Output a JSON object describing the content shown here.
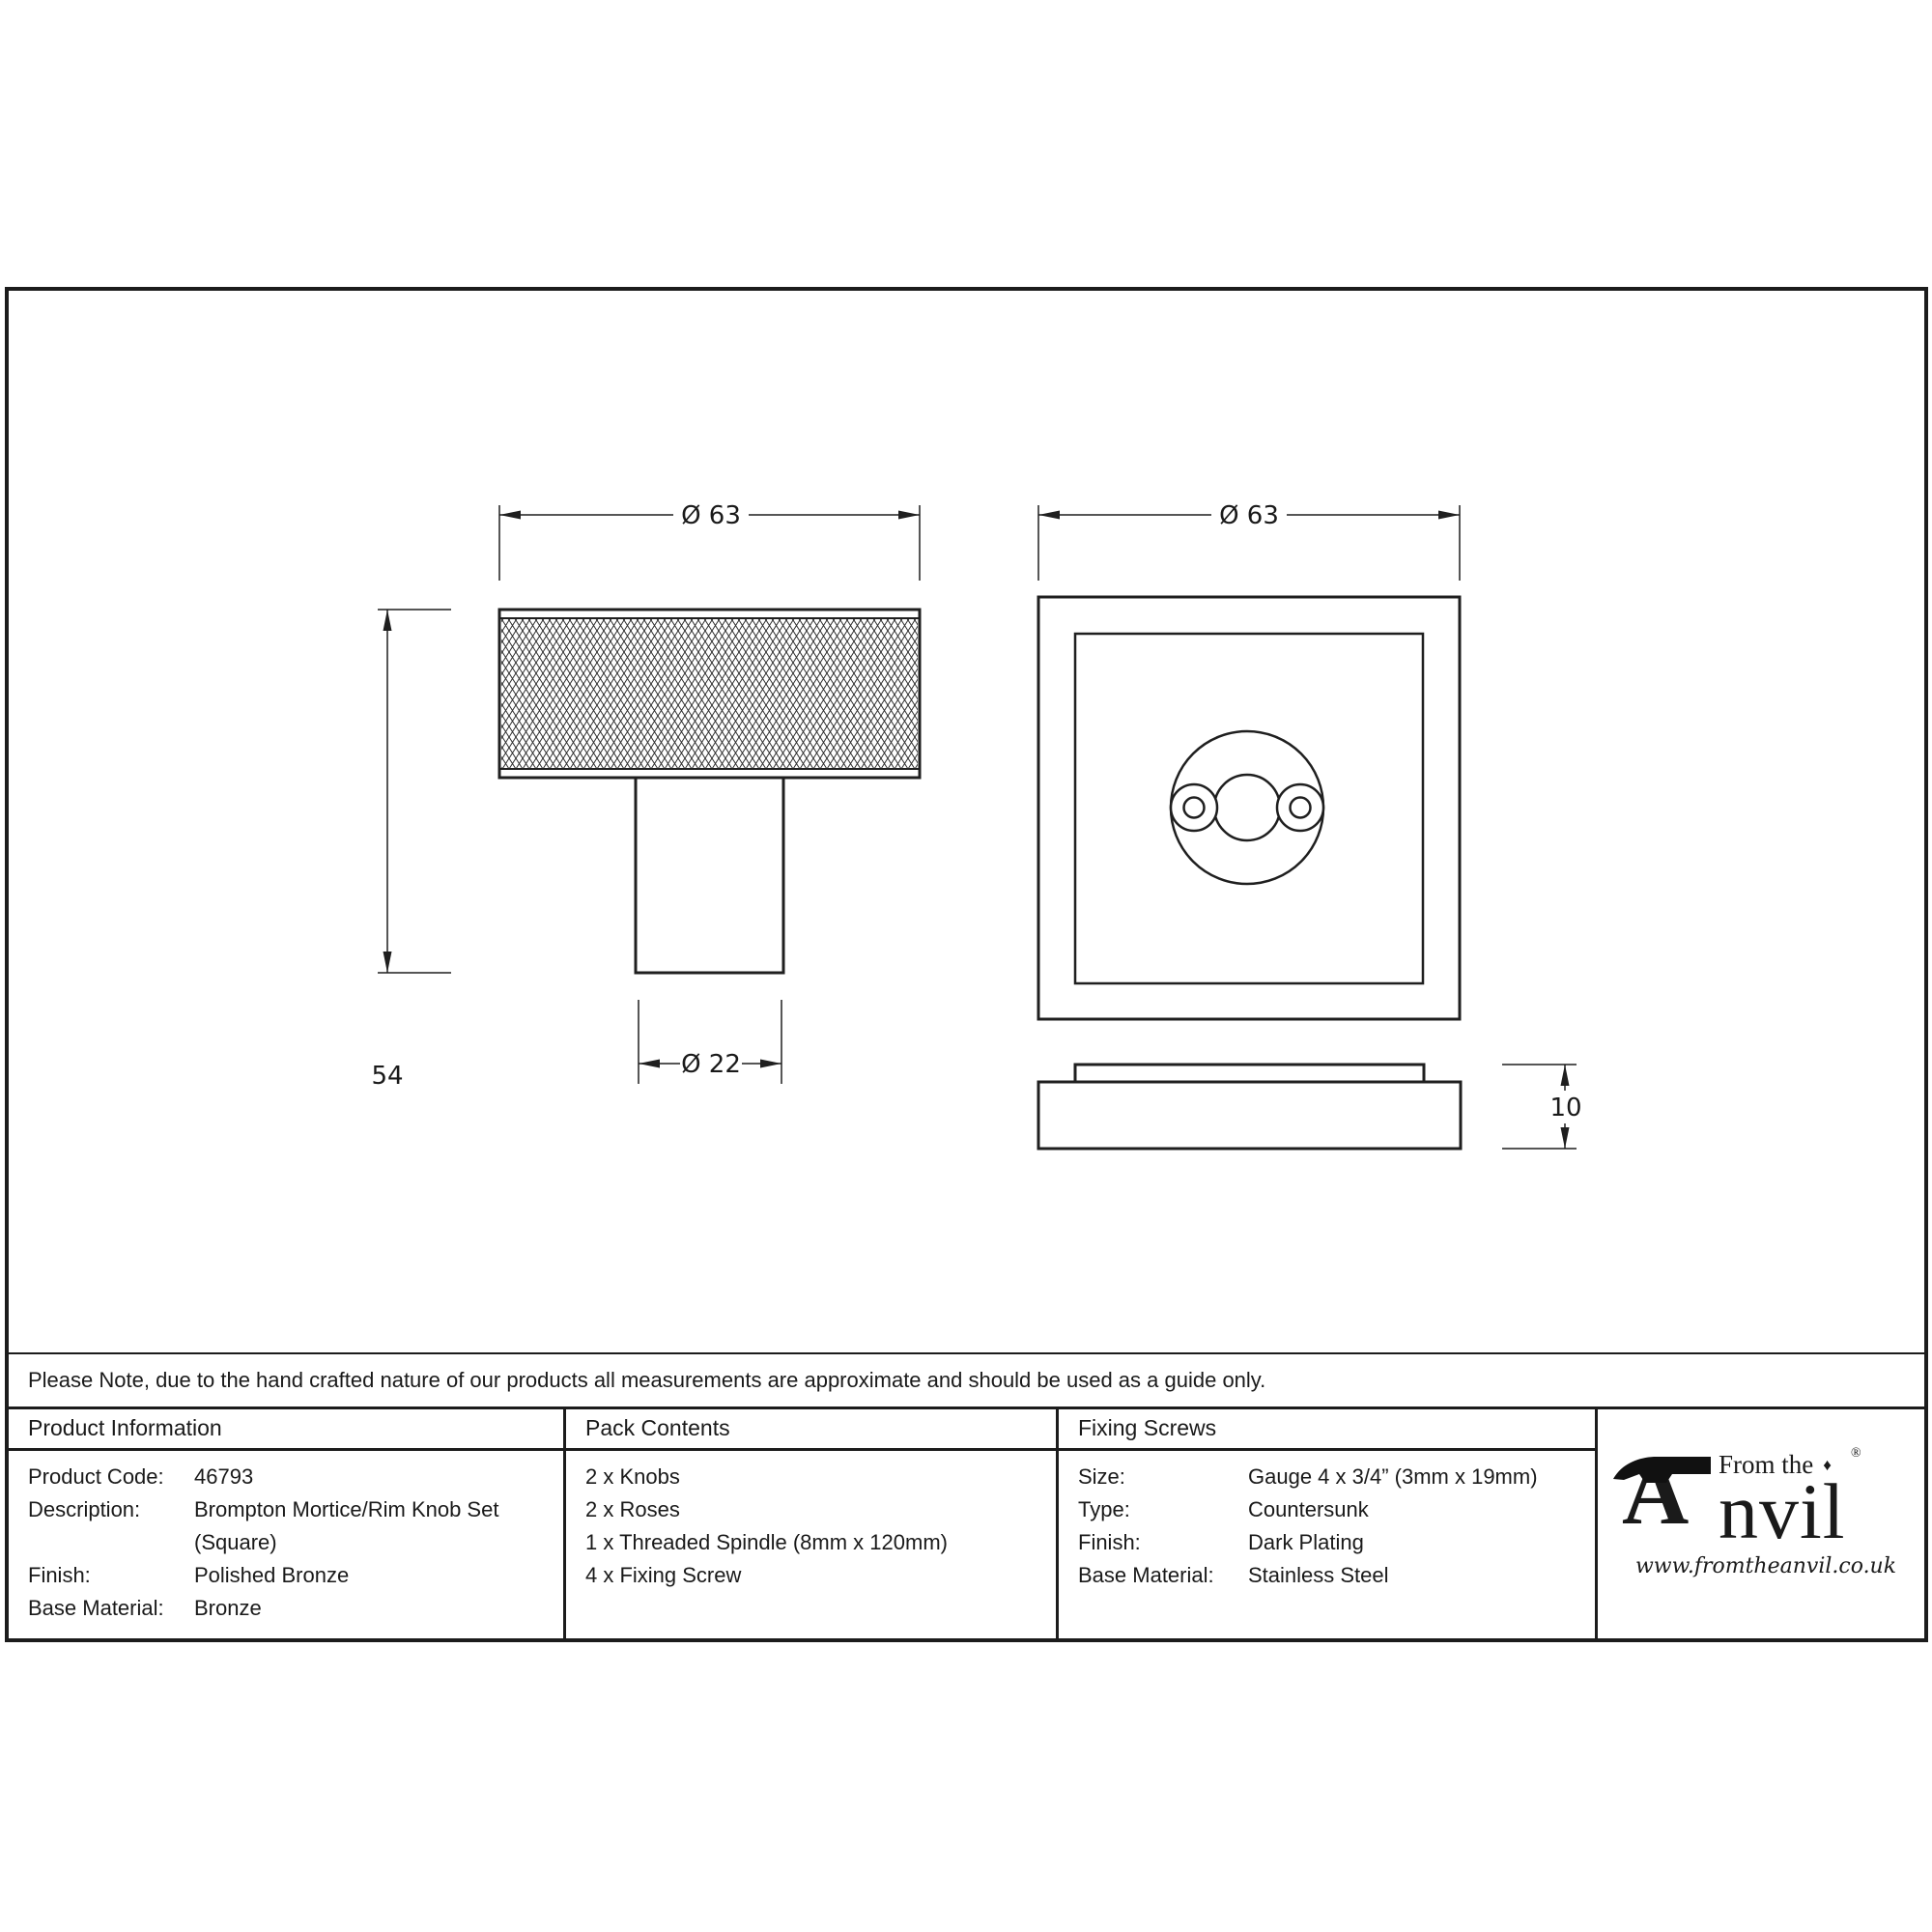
{
  "drawing": {
    "dimensions": {
      "knob_diameter": "Ø 63",
      "knob_height": "54",
      "stem_diameter": "Ø 22",
      "rose_width": "Ø 63",
      "rose_thickness": "10"
    }
  },
  "note": "Please Note, due to the hand crafted nature of our products all measurements are approximate and should be used as a guide only.",
  "table": {
    "product_information": {
      "header": "Product Information",
      "rows": [
        {
          "label": "Product Code:",
          "value": "46793"
        },
        {
          "label": "Description:",
          "value": "Brompton Mortice/Rim Knob Set\n(Square)"
        },
        {
          "label": "Finish:",
          "value": "Polished Bronze"
        },
        {
          "label": "Base Material:",
          "value": "Bronze"
        }
      ]
    },
    "pack_contents": {
      "header": "Pack Contents",
      "items": [
        "2 x Knobs",
        "2 x Roses",
        "1 x Threaded Spindle (8mm x 120mm)",
        "4 x Fixing Screw"
      ]
    },
    "fixing_screws": {
      "header": "Fixing Screws",
      "rows": [
        {
          "label": "Size:",
          "value": "Gauge 4 x 3/4” (3mm x 19mm)"
        },
        {
          "label": "Type:",
          "value": "Countersunk"
        },
        {
          "label": "Finish:",
          "value": "Dark Plating"
        },
        {
          "label": "Base Material:",
          "value": "Stainless Steel"
        }
      ]
    }
  },
  "logo": {
    "brand_prefix": "From the",
    "brand_initial": "A",
    "brand_rest": "nvil",
    "registered": "®",
    "diamond": "♦",
    "website": "www.fromtheanvil.co.uk"
  },
  "colors": {
    "line": "#1c1c1c",
    "background": "#ffffff"
  }
}
